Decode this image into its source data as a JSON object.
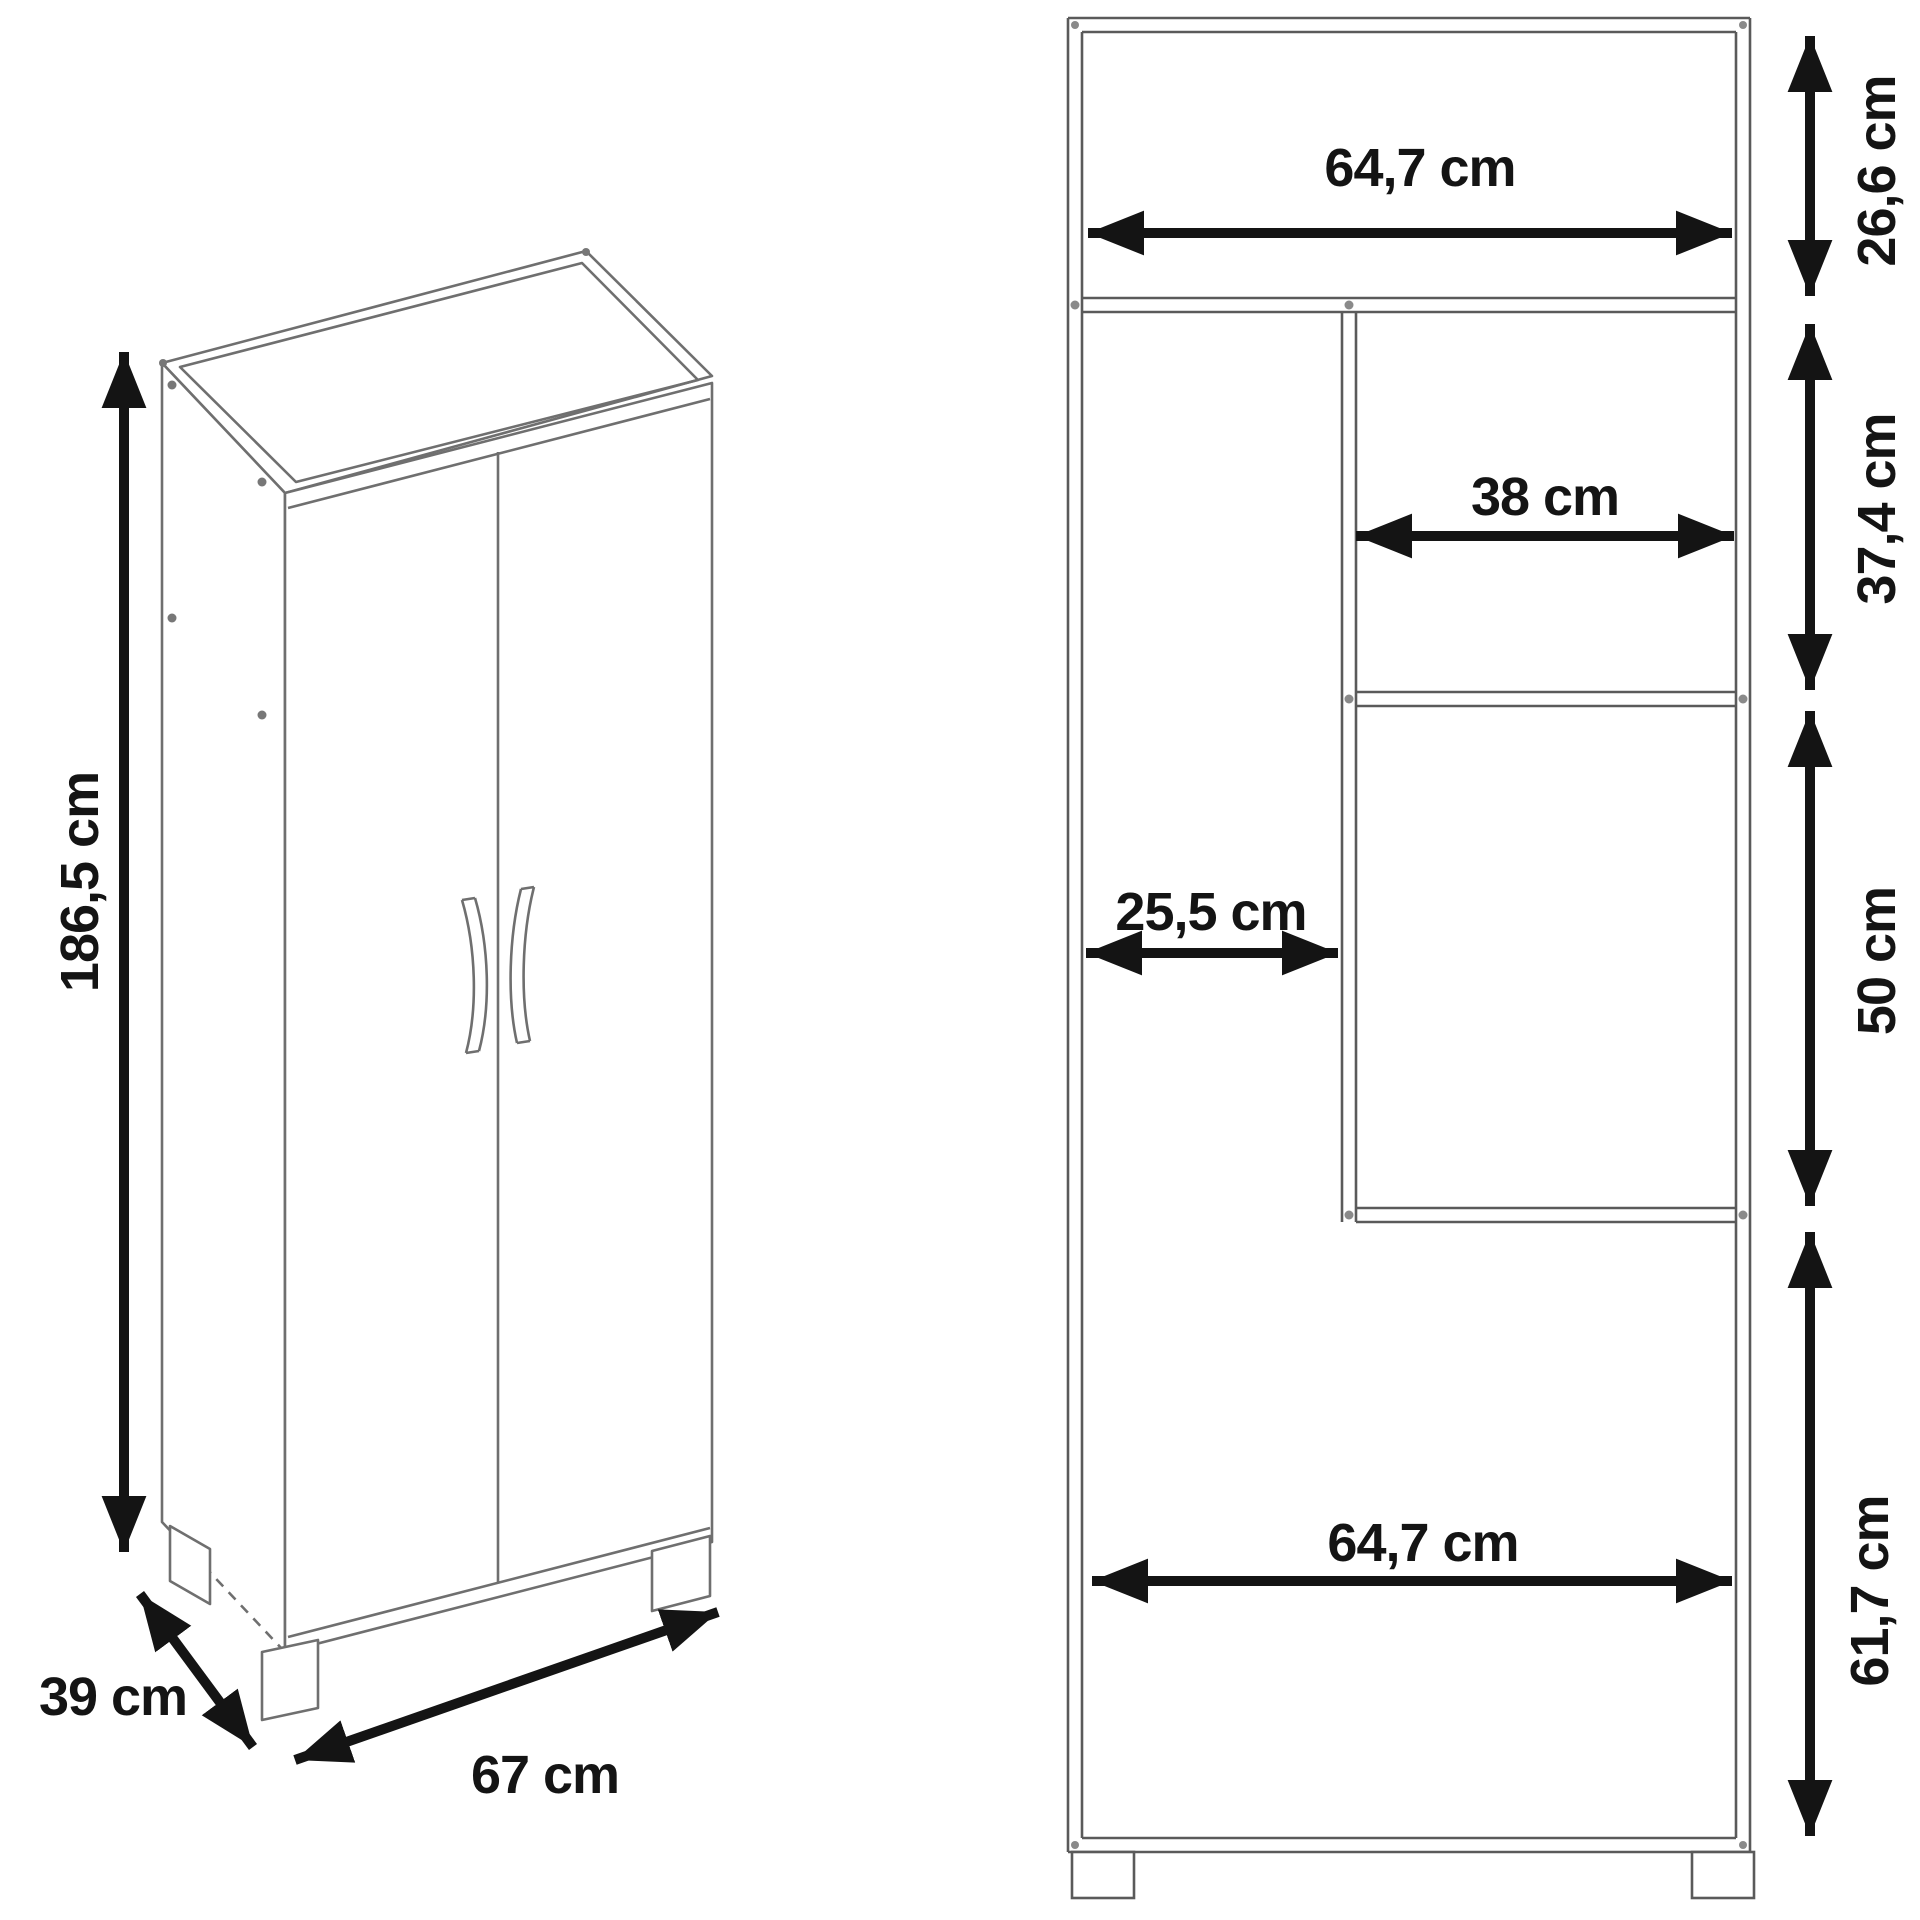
{
  "drawing": {
    "left_view": {
      "height": "186,5 cm",
      "depth": "39 cm",
      "width": "67 cm"
    },
    "front_view": {
      "top_shelf_width": "64,7 cm",
      "top_compartment_height": "26,6 cm",
      "right_shelf_width": "38 cm",
      "right_upper_compartment_height": "37,4 cm",
      "left_compartment_width": "25,5 cm",
      "right_lower_compartment_height": "50 cm",
      "bottom_compartment_width": "64,7 cm",
      "bottom_compartment_height": "61,7 cm"
    },
    "colors": {
      "outline": "#6f6f6f",
      "structure": "#5a5a5a",
      "dimension": "#141414"
    }
  }
}
